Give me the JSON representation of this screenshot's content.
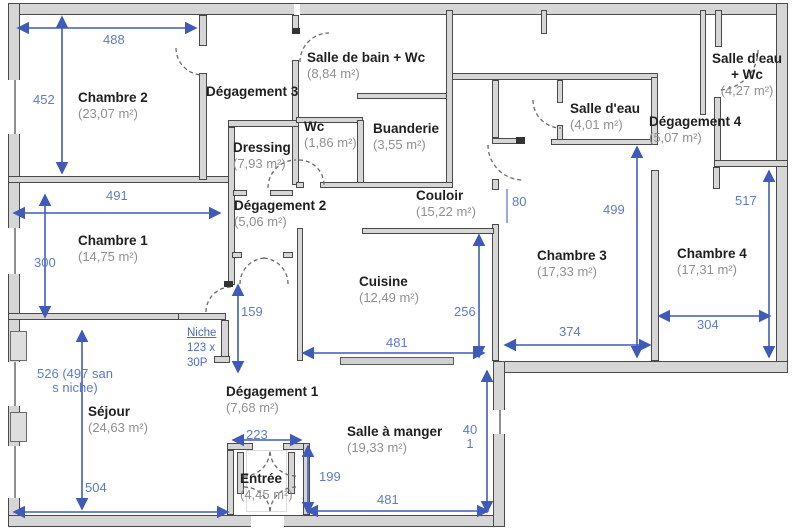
{
  "plan": {
    "colors": {
      "dim_blue_label": "#5d7bc9",
      "dim_blue_line": "#3f5bb8",
      "wall_fill": "#d6d6d6",
      "wall_edge": "#4a4a4a",
      "room_name": "#1f1f1f",
      "room_area": "#8f8f8f"
    },
    "rooms": [
      {
        "name": "Chambre 2",
        "area": "(23,07 m²)",
        "x": 78,
        "y": 90
      },
      {
        "name": "Chambre 1",
        "area": "(14,75 m²)",
        "x": 78,
        "y": 233
      },
      {
        "name": "Séjour",
        "area": "(24,63 m²)",
        "x": 88,
        "y": 404
      },
      {
        "name": "Dégagement 3",
        "area": "",
        "x": 206,
        "y": 84
      },
      {
        "name": "Dressing",
        "area": "(7,93 m²)",
        "x": 233,
        "y": 140
      },
      {
        "name": "Dégagement 2",
        "area": "(5,06 m²)",
        "x": 234,
        "y": 198
      },
      {
        "name": "Salle de bain + Wc",
        "area": "(8,84 m²)",
        "x": 307,
        "y": 50
      },
      {
        "name": "Wc",
        "area": "(1,86 m²)",
        "x": 304,
        "y": 119
      },
      {
        "name": "Buanderie",
        "area": "(3,55 m²)",
        "x": 373,
        "y": 121
      },
      {
        "name": "Couloir",
        "area": "(15,22 m²)",
        "x": 416,
        "y": 188
      },
      {
        "name": "Cuisine",
        "area": "(12,49 m²)",
        "x": 359,
        "y": 274
      },
      {
        "name": "Dégagement 1",
        "area": "(7,68 m²)",
        "x": 226,
        "y": 384
      },
      {
        "name": "Salle à manger",
        "area": "(19,33 m²)",
        "x": 347,
        "y": 424
      },
      {
        "name": "Entrée",
        "area": "(4,45 m²)",
        "x": 240,
        "y": 471
      },
      {
        "name": "Salle d'eau",
        "area": "(4,01 m²)",
        "x": 570,
        "y": 101
      },
      {
        "name": "Dégagement 4",
        "area": "(5,07 m²)",
        "x": 649,
        "y": 114
      },
      {
        "name": "Salle d'eau + Wc",
        "area": "(4,27 m²)",
        "x": 712,
        "y": 51,
        "w": 70,
        "center": true
      },
      {
        "name": "Chambre 3",
        "area": "(17,33 m²)",
        "x": 537,
        "y": 248
      },
      {
        "name": "Chambre 4",
        "area": "(17,31 m²)",
        "x": 677,
        "y": 246
      }
    ],
    "dimensions": [
      {
        "label": "488",
        "x1": 18,
        "y1": 28,
        "x2": 196,
        "y2": 28,
        "lx": 103,
        "ly": 33
      },
      {
        "label": "452",
        "x1": 62,
        "y1": 17,
        "x2": 62,
        "y2": 173,
        "lx": 33,
        "ly": 93
      },
      {
        "label": "491",
        "x1": 14,
        "y1": 213,
        "x2": 220,
        "y2": 213,
        "lx": 106,
        "ly": 189
      },
      {
        "label": "300",
        "x1": 45,
        "y1": 195,
        "x2": 45,
        "y2": 317,
        "lx": 34,
        "ly": 256
      },
      {
        "label": "526 (497 sans niche)",
        "x1": 82,
        "y1": 331,
        "x2": 82,
        "y2": 509,
        "lx": 37,
        "ly": 367,
        "lw": 76
      },
      {
        "label": "504",
        "x1": 14,
        "y1": 512,
        "x2": 228,
        "y2": 512,
        "lx": 85,
        "ly": 481
      },
      {
        "label": "159",
        "x1": 238,
        "y1": 285,
        "x2": 238,
        "y2": 372,
        "lx": 241,
        "ly": 305
      },
      {
        "label": "223",
        "x1": 233,
        "y1": 440,
        "x2": 301,
        "y2": 440,
        "lx": 246,
        "ly": 428
      },
      {
        "label": "199",
        "x1": 308,
        "y1": 446,
        "x2": 308,
        "y2": 513,
        "lx": 319,
        "ly": 470
      },
      {
        "label": "481",
        "x1": 307,
        "y1": 511,
        "x2": 488,
        "y2": 511,
        "lx": 377,
        "ly": 493
      },
      {
        "label": "401",
        "x1": 487,
        "y1": 371,
        "x2": 487,
        "y2": 512,
        "lx": 460,
        "ly": 423,
        "lw": 20
      },
      {
        "label": "481",
        "x1": 303,
        "y1": 353,
        "x2": 484,
        "y2": 353,
        "lx": 386,
        "ly": 336
      },
      {
        "label": "256",
        "x1": 479,
        "y1": 235,
        "x2": 479,
        "y2": 357,
        "lx": 454,
        "ly": 305
      },
      {
        "label": "80",
        "x1": 507,
        "y1": 189,
        "x2": 507,
        "y2": 223,
        "lx": 512,
        "ly": 195,
        "plain": true
      },
      {
        "label": "499",
        "x1": 637,
        "y1": 147,
        "x2": 637,
        "y2": 357,
        "lx": 603,
        "ly": 203
      },
      {
        "label": "374",
        "x1": 505,
        "y1": 345,
        "x2": 650,
        "y2": 345,
        "lx": 559,
        "ly": 325
      },
      {
        "label": "517",
        "x1": 769,
        "y1": 171,
        "x2": 769,
        "y2": 357,
        "lx": 735,
        "ly": 194
      },
      {
        "label": "304",
        "x1": 659,
        "y1": 316,
        "x2": 770,
        "y2": 316,
        "lx": 697,
        "ly": 318
      }
    ],
    "niche_note": {
      "line1": "Niche",
      "line2": "123 x",
      "line3": "30P",
      "x": 187,
      "y": 326
    }
  }
}
